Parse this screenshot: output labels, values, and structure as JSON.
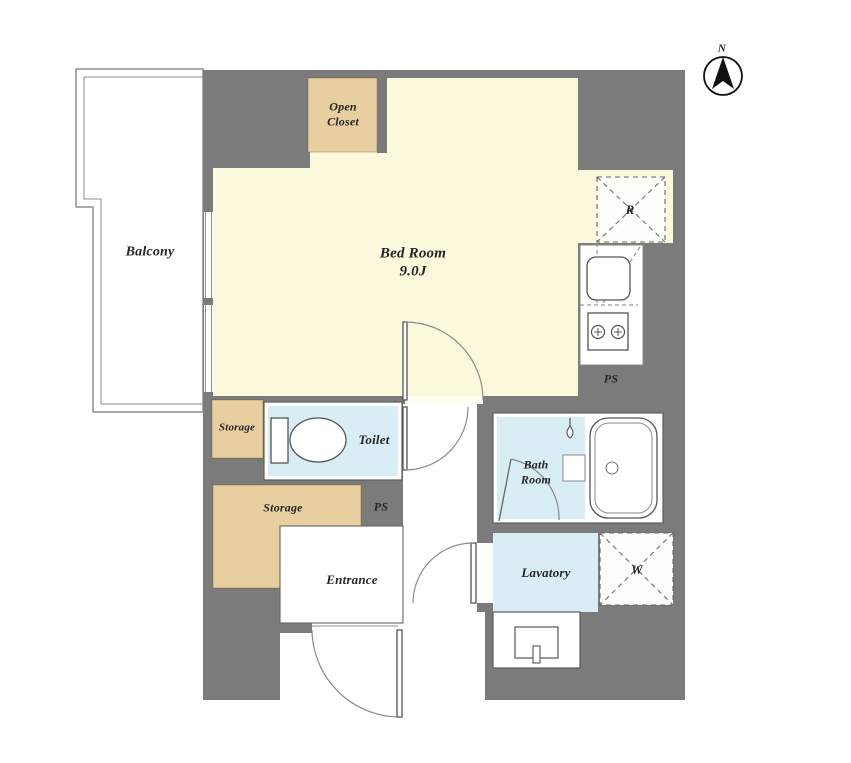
{
  "plan": {
    "compass": {
      "north_label": "N"
    },
    "labels": {
      "balcony": "Balcony",
      "open_closet_line1": "Open",
      "open_closet_line2": "Closet",
      "bedroom_name": "Bed Room",
      "bedroom_size": "9.0J",
      "refrigerator_space": "R",
      "ps_kitchen": "PS",
      "storage_small": "Storage",
      "toilet": "Toilet",
      "storage_large": "Storage",
      "ps_hall": "PS",
      "entrance": "Entrance",
      "bath_line1": "Bath",
      "bath_line2": "Room",
      "lavatory": "Lavatory",
      "washer_space": "W"
    },
    "colors": {
      "wall": "#7b7b7b",
      "room_cream": "#fbf8dc",
      "closet_tan": "#e8cfa0",
      "wet_blue": "#d9edf5"
    }
  }
}
